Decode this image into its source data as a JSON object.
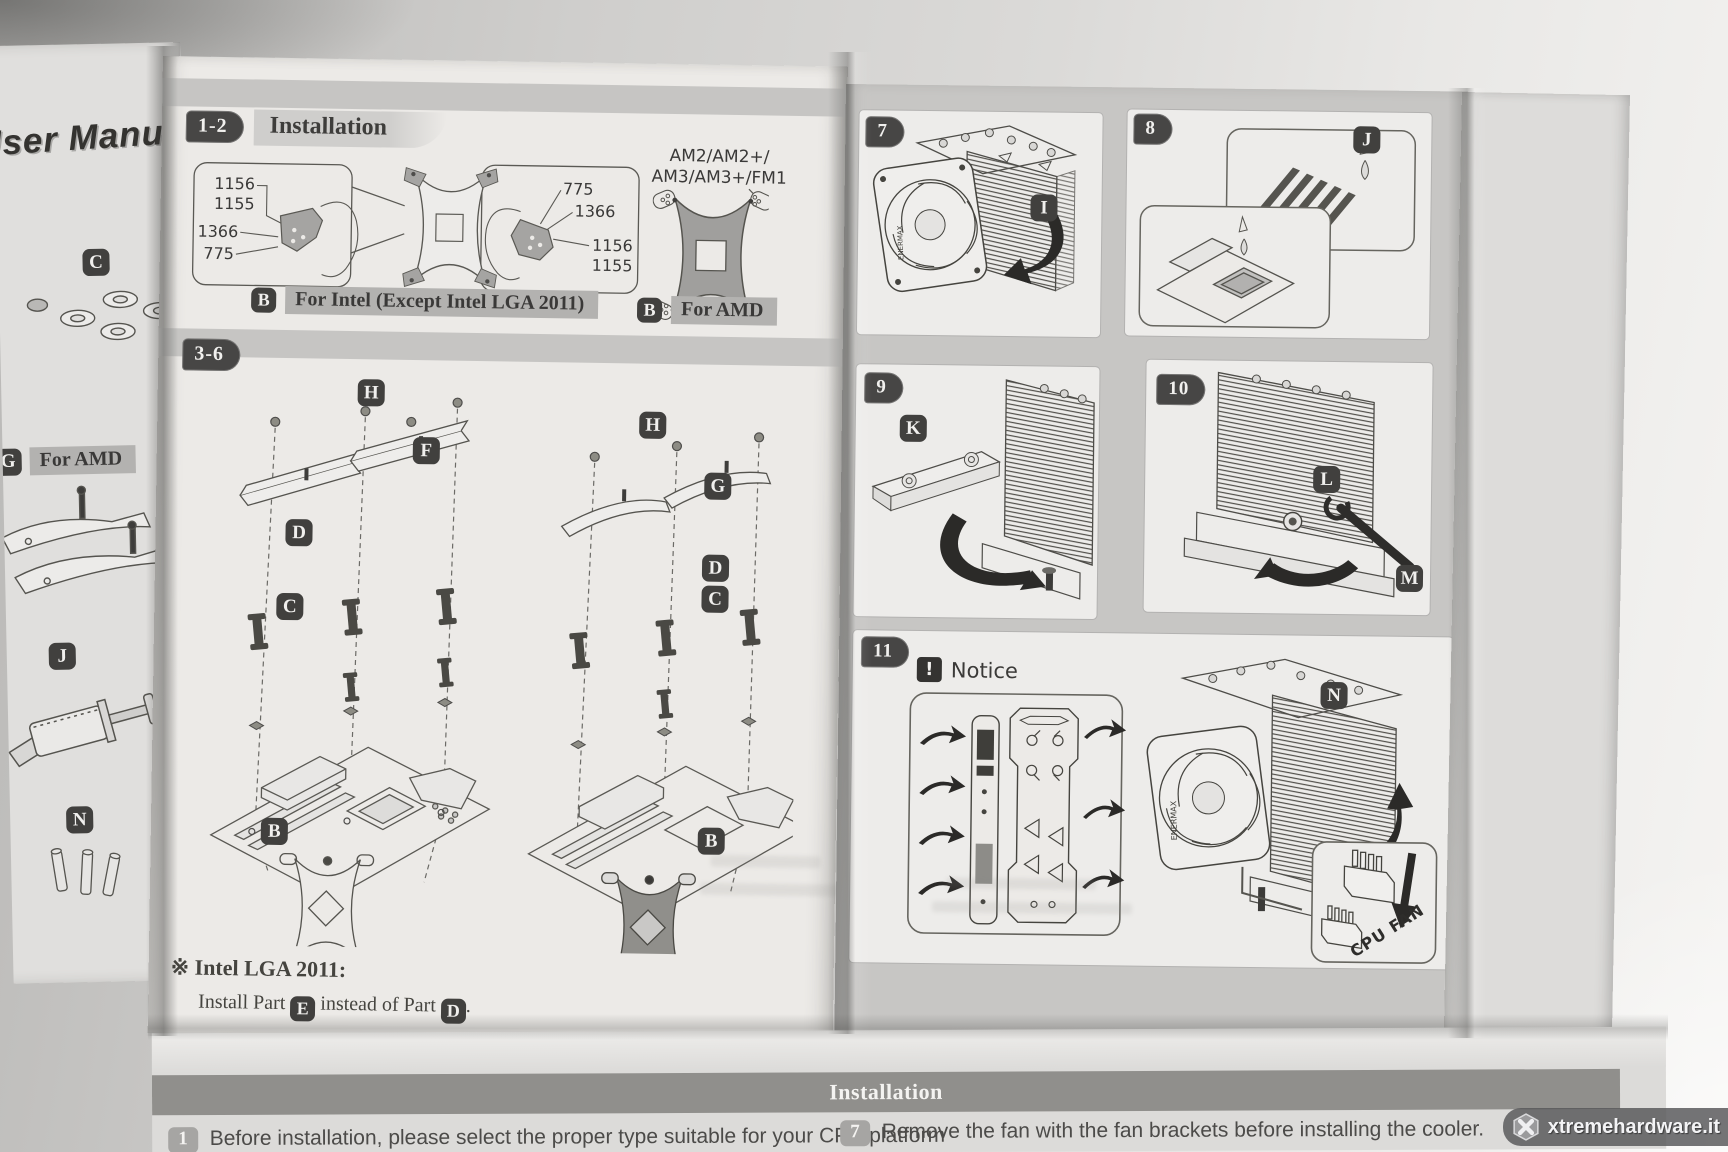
{
  "photo": {
    "watermark": "xtremehardware.it"
  },
  "cover_strip": {
    "title": "User Manual",
    "parts": [
      {
        "letter": "C"
      },
      {
        "letter": "G",
        "caption": "For AMD"
      },
      {
        "letter": "J"
      },
      {
        "letter": "N"
      }
    ]
  },
  "page_left": {
    "sec12": {
      "badge": "1-2",
      "heading": "Installation",
      "intel": {
        "left_labels": [
          "1156",
          "1155",
          "1366",
          "775"
        ],
        "right_labels": [
          "775",
          "1366",
          "1156",
          "1155"
        ],
        "tag_letter": "B",
        "tag_text": "For Intel (Except Intel LGA 2011)"
      },
      "amd": {
        "platform_line1": "AM2/AM2+/",
        "platform_line2": "AM3/AM3+/FM1",
        "tag_letter": "B",
        "tag_text": "For AMD"
      }
    },
    "sec36": {
      "badge": "3-6",
      "intel_parts": {
        "h": "H",
        "f": "F",
        "d": "D",
        "c": "C",
        "b": "B"
      },
      "amd_parts": {
        "h": "H",
        "g": "G",
        "d": "D",
        "c": "C",
        "b": "B"
      },
      "note_heading": "※ Intel LGA 2011:",
      "note": {
        "pre": "Install Part",
        "part_e": "E",
        "mid": "instead of Part",
        "part_d": "D",
        "period": "."
      }
    }
  },
  "page_right": {
    "step7": {
      "num": "7",
      "letter": "I",
      "fan_brand": "ENERMAX"
    },
    "step8": {
      "num": "8",
      "letter": "J"
    },
    "step9": {
      "num": "9",
      "letter": "K"
    },
    "step10": {
      "num": "10",
      "letter_l": "L",
      "letter_m": "M"
    },
    "step11": {
      "num": "11",
      "letter": "N",
      "notice_mark": "!",
      "notice_label": "Notice",
      "cpu_fan_label": "CPU FAN",
      "fan_brand": "ENERMAX"
    }
  },
  "footer": {
    "bar_title": "Installation",
    "left_num": "1",
    "left_text": "Before installation, please select the proper type suitable for your CPU platform",
    "right_num": "7",
    "right_text": "Remove the fan with the fan brackets before installing the cooler."
  }
}
